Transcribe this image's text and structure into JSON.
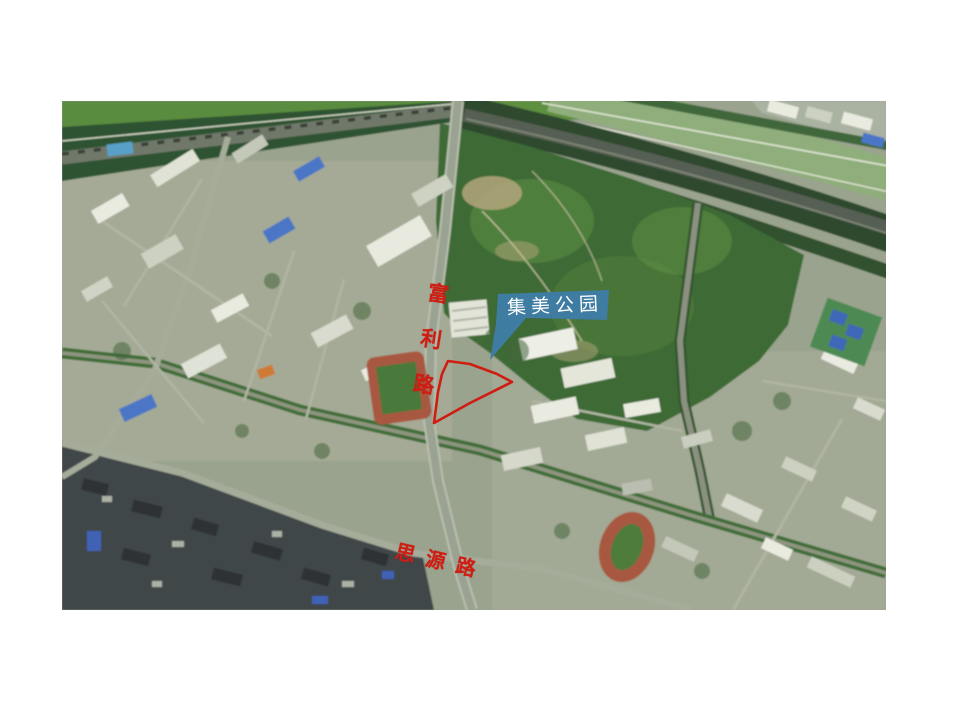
{
  "annotations": {
    "park_callout": {
      "label": "集美公园"
    },
    "fuli_road": {
      "label": "富利路"
    },
    "siyuan_road": {
      "label": "思源路"
    }
  },
  "colors": {
    "page_background": "#ffffff",
    "annotation_red": "#cf1d12",
    "callout_blue": "#3e7ca2",
    "callout_text": "#ffffff"
  }
}
